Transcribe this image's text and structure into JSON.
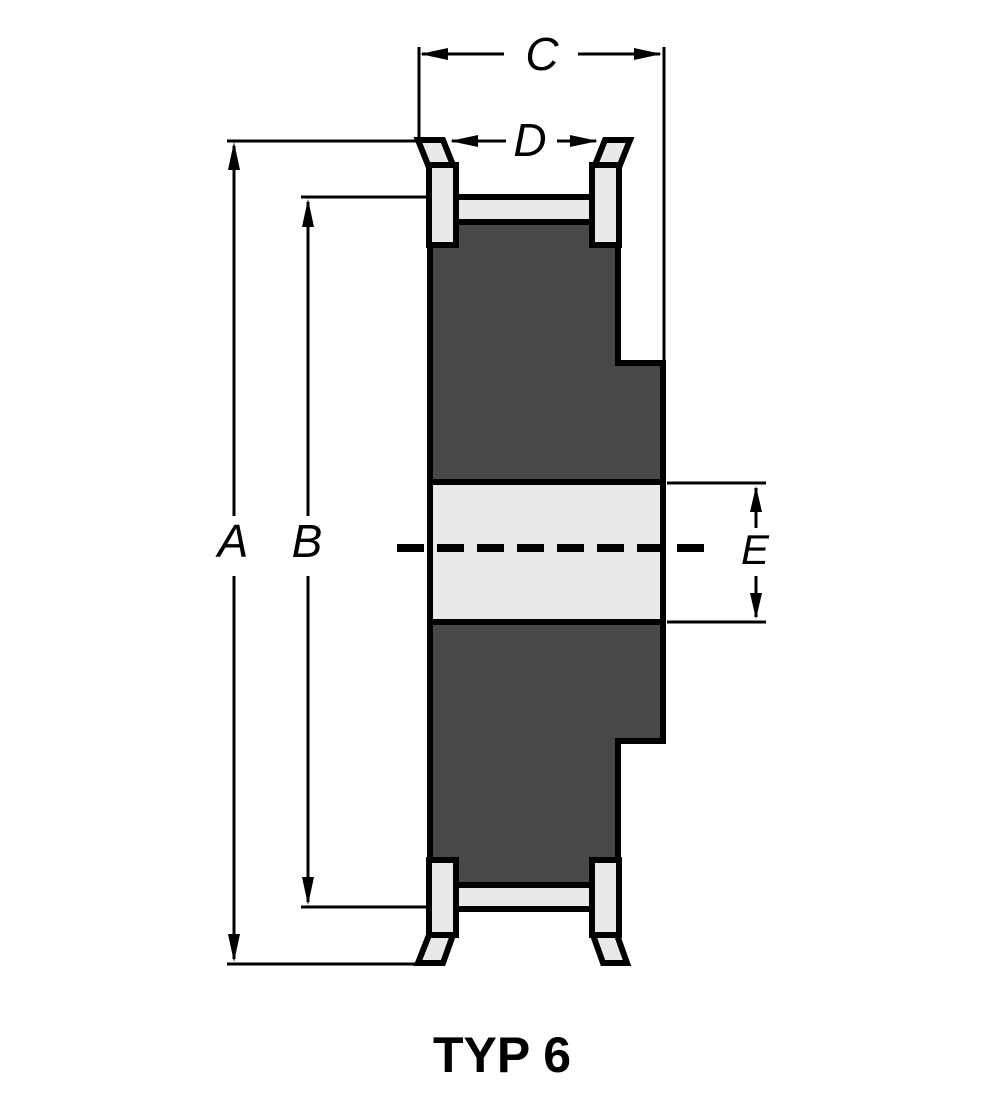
{
  "diagram": {
    "caption": "TYP 6",
    "labels": {
      "a": "A",
      "b": "B",
      "c": "C",
      "d": "D",
      "e": "E"
    },
    "dimension_orientations": {
      "a": "vertical",
      "b": "vertical",
      "c": "horizontal",
      "d": "horizontal",
      "e": "vertical"
    }
  },
  "colors": {
    "background": "#ffffff",
    "outline": "#000000",
    "body_fill": "#484848",
    "flange_fill": "#e9e9e9",
    "dimension_line": "#000000"
  }
}
